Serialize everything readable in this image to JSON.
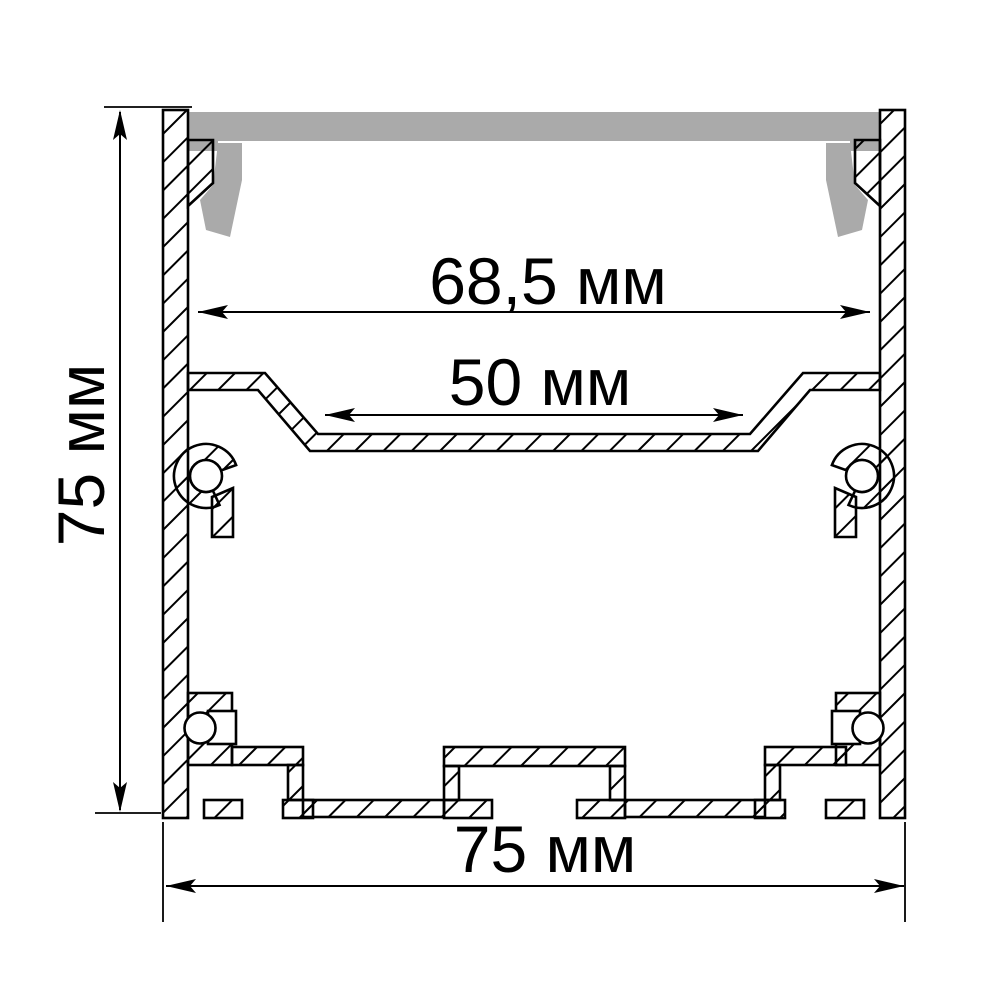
{
  "diagram": {
    "kind": "technical-cross-section-drawing",
    "labels": {
      "height": "75 мм",
      "inner_width": "68,5 мм",
      "shelf_width": "50 мм",
      "overall_width": "75 мм"
    },
    "colors": {
      "line": "#000000",
      "diffuser": "#aaaaaa",
      "background": "#ffffff"
    }
  }
}
